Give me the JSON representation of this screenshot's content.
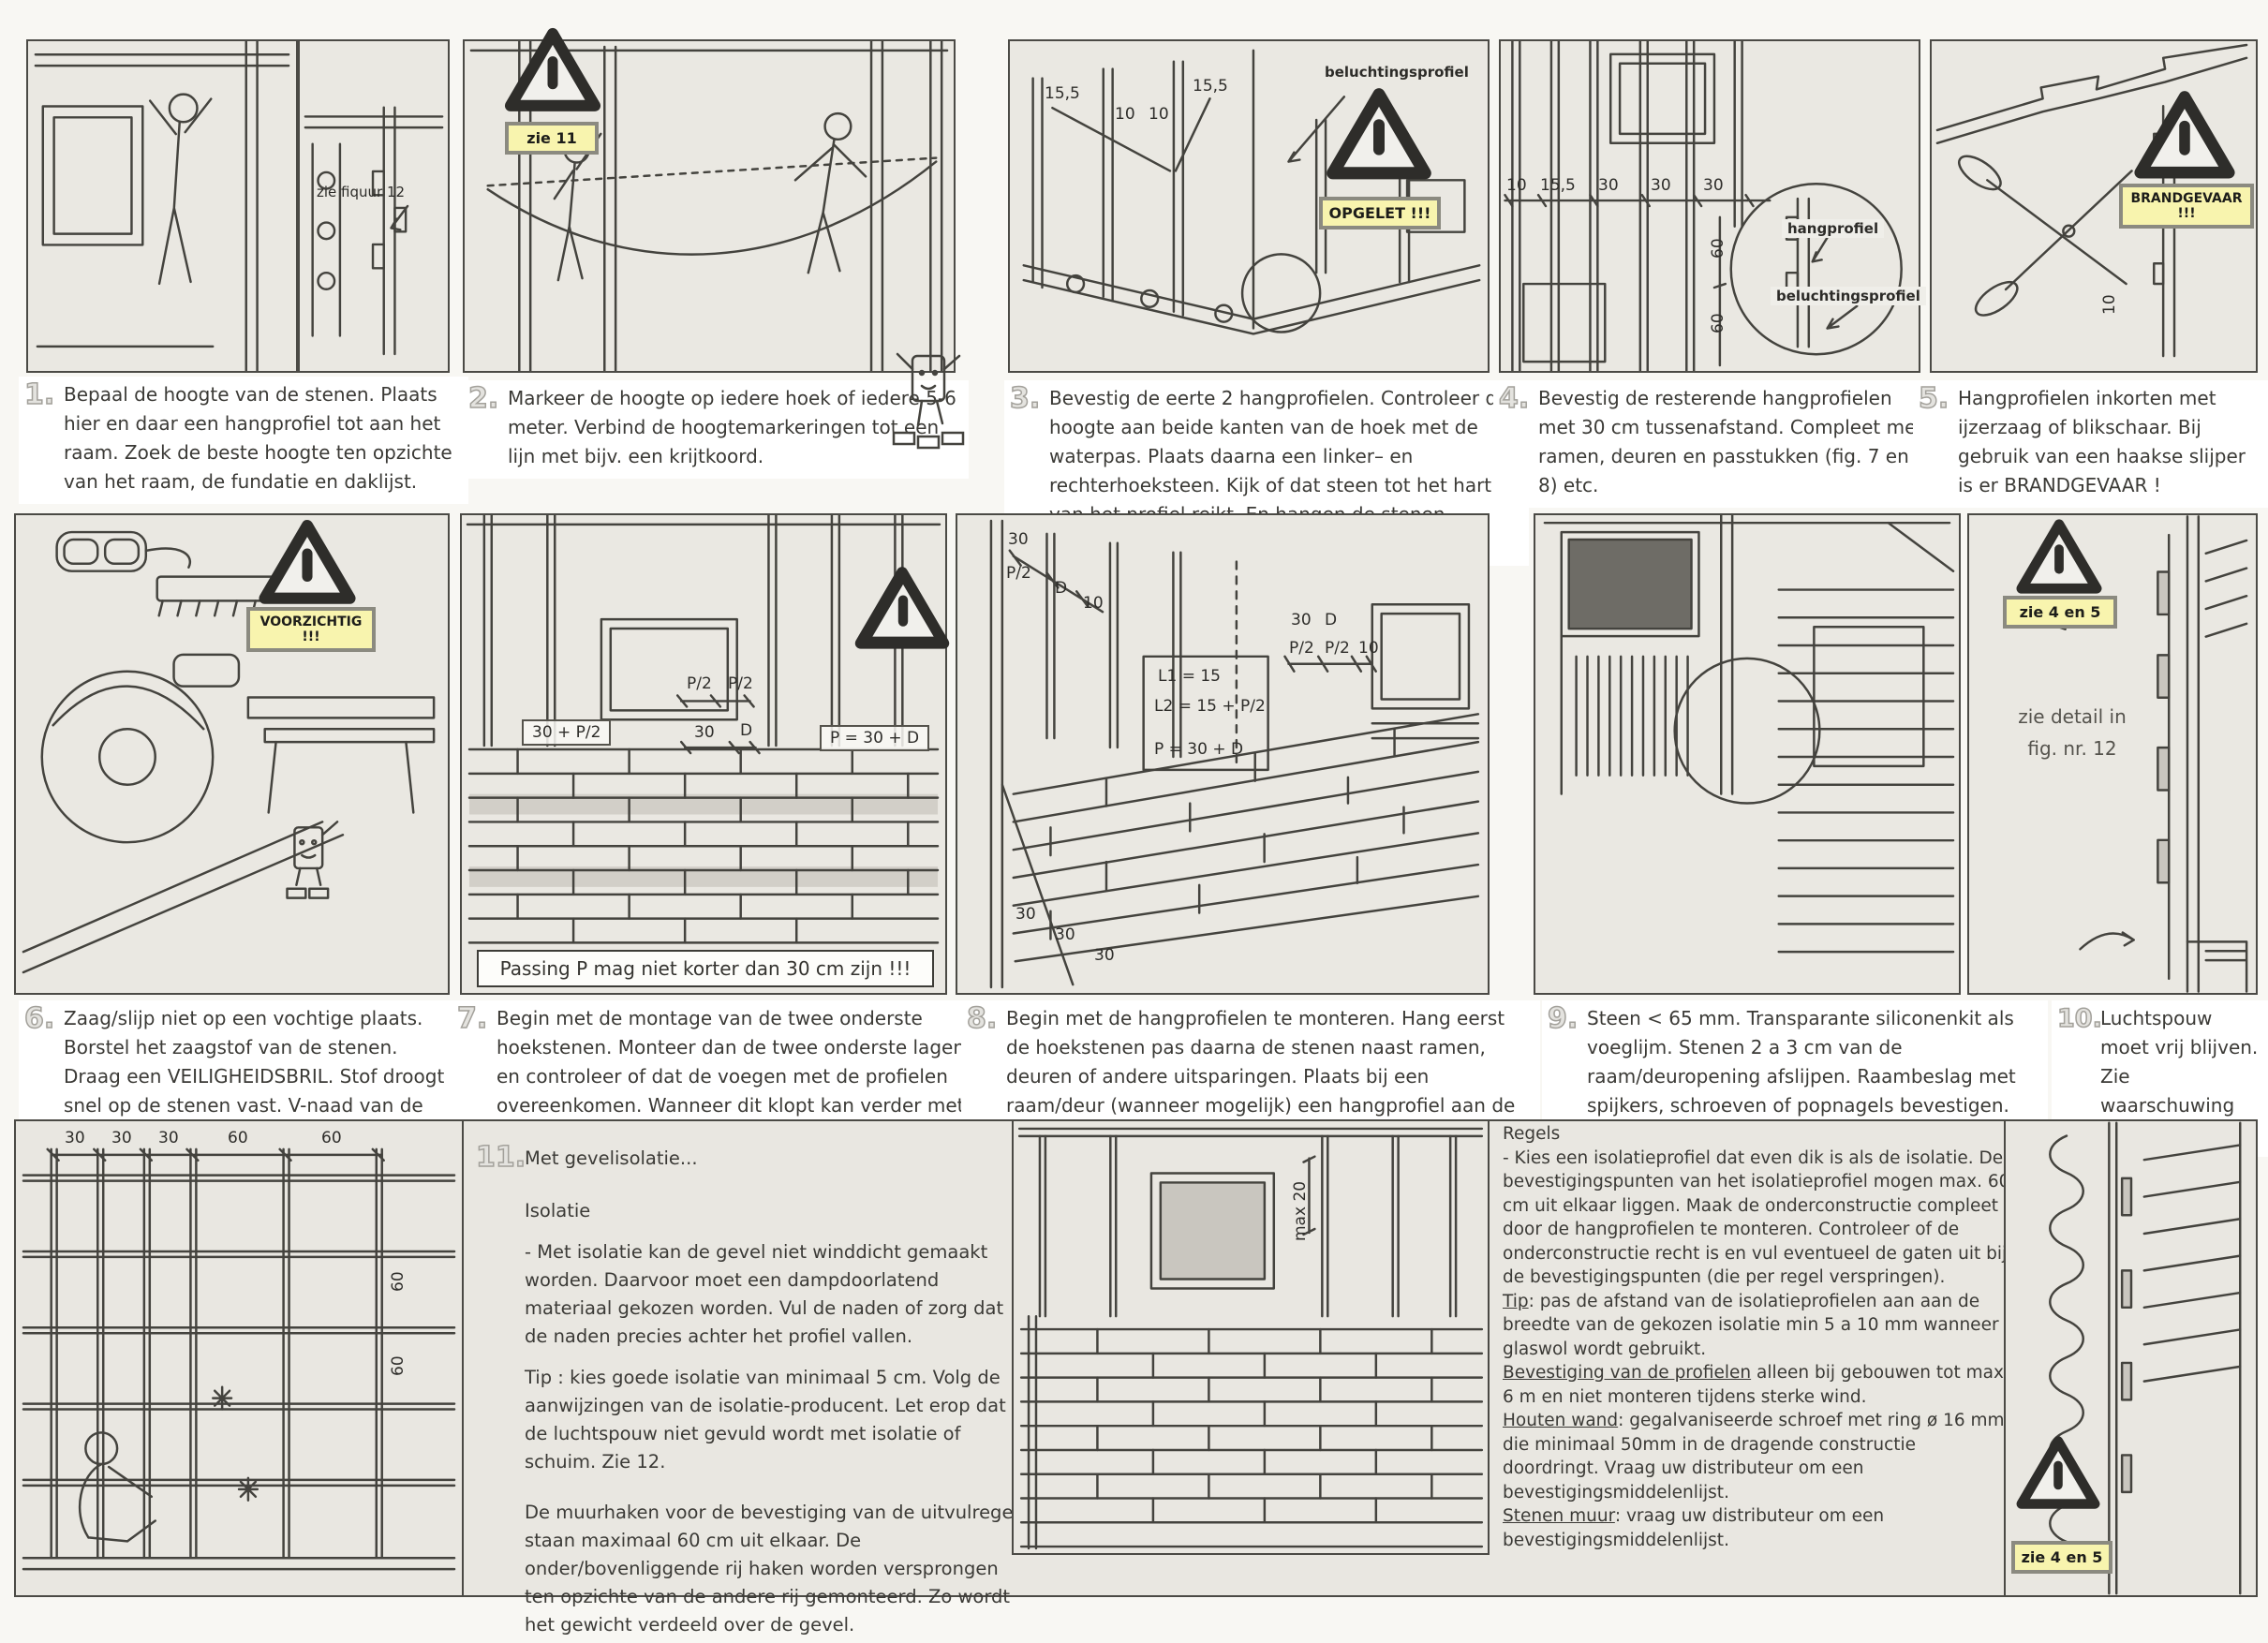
{
  "title": "MONTAGE",
  "colors": {
    "paper": "#f8f7f3",
    "panel": "#eae8e2",
    "ink": "#3b3a36",
    "warning_bg": "#f8f4ae",
    "dark_fill": "#6e6c66"
  },
  "steps": [
    {
      "num": "1.",
      "text": "Bepaal de hoogte van de stenen. Plaats hier en daar een hangprofiel tot aan het raam. Zoek de beste hoogte ten opzichte van het raam, de fundatie en daklijst."
    },
    {
      "num": "2.",
      "text": "Markeer de hoogte op iedere hoek of iedere 5-6 meter. Verbind de hoogtemarkeringen tot een lijn met bijv. een krijtkoord."
    },
    {
      "num": "3.",
      "text": "Bevestig de eerte 2 hangprofielen. Controleer de hoogte aan beide kanten van de hoek met de waterpas. Plaats daarna een linker– en rechterhoeksteen. Kijk of dat steen tot het hart van het profiel reikt. En hangen de stenen waterpas ???"
    },
    {
      "num": "4.",
      "text": "Bevestig de resterende hangprofielen met 30 cm tussenafstand. Compleet met ramen, deuren en passtukken (fig. 7 en 8) etc."
    },
    {
      "num": "5.",
      "text": "Hangprofielen inkorten met ijzerzaag of blikschaar. Bij gebruik van een haakse slijper is er BRANDGEVAAR !"
    },
    {
      "num": "6.",
      "text": "Zaag/slijp niet op een vochtige plaats. Borstel het zaagstof van de stenen. Draag een VEILIGHEIDSBRIL. Stof droogt snel op de stenen vast. V-naad van de staande voeg bijslijpen."
    },
    {
      "num": "7.",
      "text": "Begin met de montage van de twee onderste hoekstenen. Monteer dan de twee onderste lagen en controleer of dat de voegen met de profielen overeenkomen. Wanneer dit klopt kan verder met monteren gegaan worden."
    },
    {
      "num": "8.",
      "text": "Begin met de hangprofielen te monteren. Hang eerst de hoekstenen pas daarna de stenen naast ramen, deuren of andere uitsparingen. Plaats bij een raam/deur (wanneer mogelijk) een hangprofiel aan de binnenkant."
    },
    {
      "num": "9.",
      "text": "Steen < 65 mm. Transparante siliconenkit als voeglijm. Stenen 2 a 3 cm van de raam/deuropening afslijpen. Raambeslag met spijkers, schroeven of popnagels bevestigen. Verbindingen met een popnagel poppen."
    },
    {
      "num": "10.",
      "text": "Luchtspouw moet vrij blijven. Zie waarschuwing 4/5"
    }
  ],
  "step11": {
    "num": "11.",
    "title": "Met gevelisolatie...",
    "heading": "Isolatie",
    "para1": "- Met isolatie kan de gevel niet winddicht gemaakt worden. Daarvoor moet een dampdoorlatend materiaal gekozen worden. Vul de naden of zorg dat de naden precies achter het profiel vallen.",
    "para2": "Tip : kies goede isolatie van minimaal 5 cm. Volg de aanwijzingen van de isolatie-producent. Let erop dat de luchtspouw niet gevuld wordt met isolatie of schuim. Zie 12.",
    "para3": "De muurhaken voor de bevestiging van de uitvulregel staan maximaal 60 cm uit elkaar. De onder/bovenliggende rij haken worden versprongen ten opzichte van de andere rij gemonteerd. Zo wordt het gewicht verdeeld over de gevel."
  },
  "regels": {
    "heading": "Regels",
    "intro": "- Kies een isolatieprofiel dat even dik is als de isolatie. De bevestigingspunten van het isolatieprofiel mogen max. 60 cm uit elkaar liggen. Maak de onderconstructie compleet door de hangprofielen te monteren. Controleer of de onderconstructie recht is en vul eventueel de gaten uit bij de bevestigingspunten (die per regel verspringen).",
    "items": [
      {
        "head": "Tip",
        "text": ": pas de afstand van de isolatieprofielen aan aan de breedte van de gekozen isolatie min 5 a 10 mm wanneer glaswol wordt gebruikt."
      },
      {
        "head": "Bevestiging van de profielen",
        "text": " alleen bij gebouwen tot max. 6 m en niet monteren tijdens sterke wind."
      },
      {
        "head": "Houten wand",
        "text": ": gegalvaniseerde schroef met ring ø 16 mm die minimaal 50mm in de dragende constructie doordringt. Vraag uw distributeur om een bevestigingsmiddelenlijst."
      },
      {
        "head": "Stenen muur",
        "text": ": vraag uw distributeur om een bevestigingsmiddelenlijst."
      }
    ]
  },
  "warn": {
    "zie11": "zie 11",
    "opgelet": "OPGELET !!!",
    "brandgevaar": "BRANDGEVAAR !!!",
    "voorzichtig": "VOORZICHTIG !!!",
    "zie45_top": "zie 4 en 5",
    "zie45_bottom": "zie 4 en 5"
  },
  "annotations": {
    "zie_figuur": "zie fiquur 12",
    "beluchtingsprofiel_top": "beluchtingsprofiel",
    "hangprofiel": "hangprofiel",
    "beluchtingsprofiel_detail": "beluchtingsprofiel",
    "zie_detail_line1": "zie detail in",
    "zie_detail_line2": "fig. nr. 12",
    "passing": "Passing P mag niet korter dan 30 cm zijn !!!",
    "max20": "max 20"
  },
  "dims": {
    "p3": [
      "15,5",
      "10",
      "10",
      "15,5"
    ],
    "p4_h": [
      "10",
      "15,5",
      "30",
      "30",
      "30"
    ],
    "p4_v": [
      "60",
      "60"
    ],
    "p5": [
      "10"
    ],
    "p7_box_left": "30 + P/2",
    "p7_top": [
      "P/2",
      "P/2"
    ],
    "p7_mid": [
      "30",
      "D"
    ],
    "p7_box_right": "P = 30 + D",
    "p8_corner": [
      "30",
      "P/2",
      "D",
      "10"
    ],
    "p8_window_top": [
      "30",
      "D"
    ],
    "p8_window": [
      "P/2",
      "P/2",
      "10"
    ],
    "p8_formulas": [
      "L1 = 15",
      "L2 = 15 + P/2",
      "P = 30 + D"
    ],
    "p8_bottom": [
      "30",
      "30",
      "30"
    ],
    "p11a_top": [
      "30",
      "30",
      "30",
      "60",
      "60"
    ],
    "p11a_side": [
      "60",
      "60"
    ]
  }
}
